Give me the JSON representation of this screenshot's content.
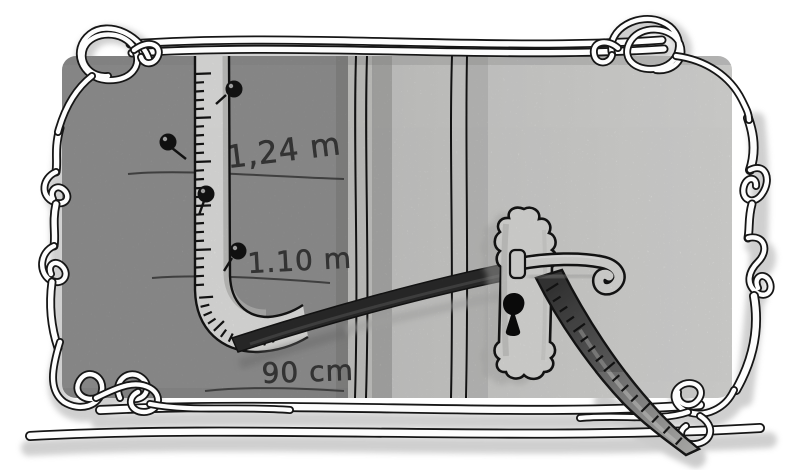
{
  "artwork": {
    "description": "Hand-drawn grayscale illustration: a measuring tape pinned to a wall beside a door, draped over the lever door handle, with pencilled height marks on the wall",
    "frame_style": "art-nouveau ribbon frame with corner knots",
    "measurements": [
      {
        "name": "upper-mark",
        "label": "1,24 m"
      },
      {
        "name": "middle-mark",
        "label": "1.10 m"
      },
      {
        "name": "lower-mark",
        "label": "90 cm"
      }
    ],
    "objects": {
      "tape": "measuring tape with tick marks",
      "door_handle": "lever door handle",
      "key_plate": "ornate keyhole escutcheon",
      "pins": 4,
      "pencil_lines": 3
    },
    "colors": {
      "background": "#ffffff",
      "frame_shadow": "#cdcdcd",
      "ink": "#161616",
      "wall": "#9d9d9d",
      "door": "#dedddb",
      "door_light": "#e9e9e7",
      "strip_light": "#d5d5d2",
      "strip_shadow": "#b2b2b0",
      "tape_front": "#f3f3f1",
      "tape_back": "#2e2e2e",
      "metal": "#ebebe9",
      "pencil": "#3d3d3d"
    }
  }
}
